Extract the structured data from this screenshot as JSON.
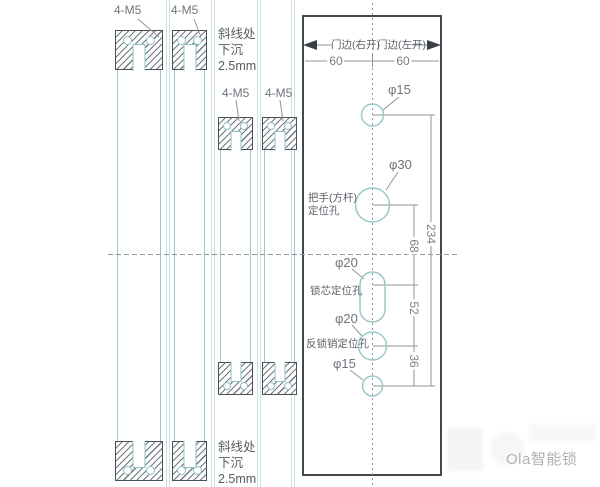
{
  "colors": {
    "teal_line": "#9cc7c9",
    "dark_outline": "#4a5056",
    "dimension_line": "#8f959a",
    "label_text": "#6f757c",
    "watermark_text": "#aeb2ae"
  },
  "left_section": {
    "m5_labels": [
      "4-M5",
      "4-M5",
      "4-M5",
      "4-M5"
    ],
    "note": {
      "line1": "斜线处",
      "line2": "下沉",
      "line3": "2.5mm"
    }
  },
  "template_plate": {
    "edge_labels": {
      "left": "门边(右开)",
      "right": "门边(左开)"
    },
    "top_dims": {
      "left": "60",
      "right": "60"
    },
    "holes": {
      "top_hole_label": "φ15",
      "handle_hole_label": "φ30",
      "handle_hole_name_line1": "把手(方杆)",
      "handle_hole_name_line2": "定位孔",
      "core_hole_label": "φ20",
      "core_hole_name": "锁芯定位孔",
      "deadbolt_hole_label": "φ20",
      "deadbolt_hole_name": "反锁销定位孔",
      "bottom_hole_label": "φ15"
    },
    "dims": {
      "total": "234",
      "handle_to_core": "68",
      "core_to_deadbolt": "52",
      "deadbolt_to_bottom": "36"
    }
  },
  "watermark": {
    "brand": "Ola智能锁"
  }
}
